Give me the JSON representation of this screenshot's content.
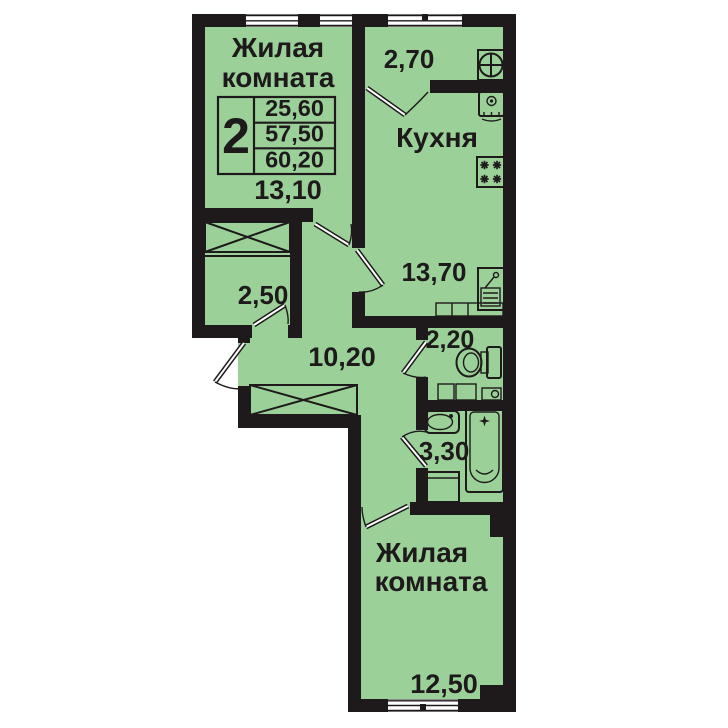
{
  "colors": {
    "floor_green": "#9bd199",
    "line_black": "#1e1a1b",
    "background": "#ffffff"
  },
  "info_table": {
    "rooms_count": "2",
    "values": [
      "25,60",
      "57,50",
      "60,20"
    ]
  },
  "rooms": {
    "living_top": {
      "label_line1": "Жилая",
      "label_line2": "комната",
      "area": "13,10"
    },
    "balcony": {
      "area": "2,70"
    },
    "kitchen": {
      "label": "Кухня",
      "area": "13,70"
    },
    "storage": {
      "area": "2,50"
    },
    "hallway": {
      "area": "10,20"
    },
    "toilet": {
      "area": "2,20"
    },
    "bathroom": {
      "area": "3,30"
    },
    "living_bottom": {
      "label_line1": "Жилая",
      "label_line2": "комната",
      "area": "12,50"
    }
  },
  "icons": {
    "fan": "fan-icon",
    "boiler": "boiler-icon",
    "stove": "stove-icon",
    "kitchen_sink": "kitchen-sink-icon",
    "kitchen_counter": "kitchen-counter",
    "toilet": "toilet-icon",
    "vanity": "vanity-sink-icon",
    "washbasin": "washbasin-icon",
    "bathtub": "bathtub-icon",
    "washing_machine": "washing-machine-icon",
    "wardrobe": "wardrobe-crossbox"
  }
}
